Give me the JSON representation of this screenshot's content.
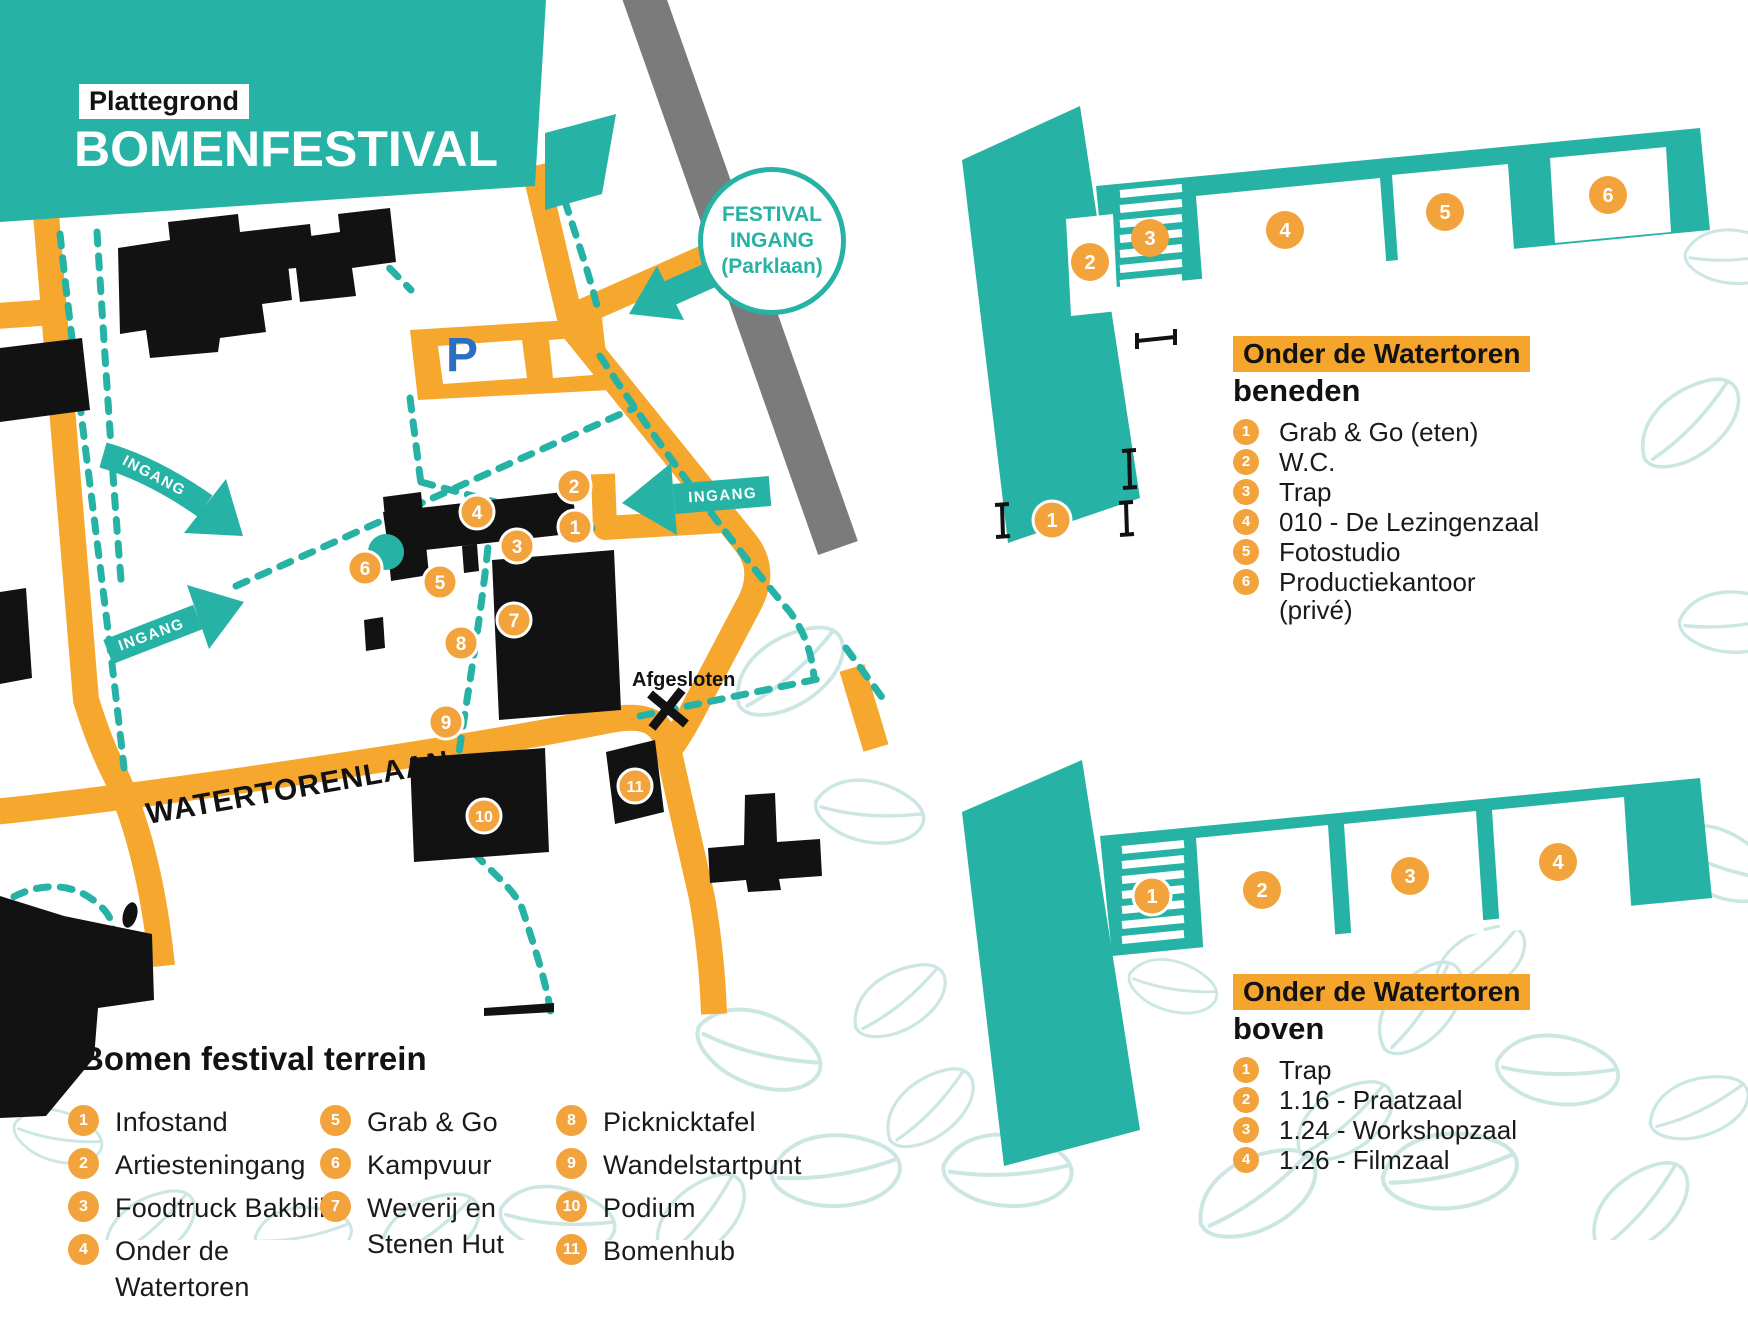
{
  "colors": {
    "teal": "#26B2A4",
    "orange": "#F6A72E",
    "marker": "#F2A33C",
    "highlight": "#F5A42C",
    "ink": "#121212",
    "gray_road": "#7B7B7B",
    "leaf": "#CBE6E3",
    "parking_blue": "#2B6FC4"
  },
  "title": {
    "badge": "Plattegrond",
    "main": "BOMENFESTIVAL"
  },
  "festival_entrance": {
    "line1": "FESTIVAL",
    "line2": "INGANG",
    "line3": "(Parklaan)"
  },
  "map": {
    "street_label": "WATERTORENLAAN",
    "closed_label": "Afgesloten",
    "entrance_label": "INGANG",
    "parking_label": "P",
    "markers": [
      {
        "number": "1"
      },
      {
        "number": "2"
      },
      {
        "number": "3"
      },
      {
        "number": "4"
      },
      {
        "number": "5"
      },
      {
        "number": "6"
      },
      {
        "number": "7"
      },
      {
        "number": "8"
      },
      {
        "number": "9"
      },
      {
        "number": "10"
      },
      {
        "number": "11"
      }
    ]
  },
  "terrain_legend": {
    "title": "Bomen festival terrein",
    "items": [
      {
        "number": "1",
        "label": "Infostand"
      },
      {
        "number": "2",
        "label": "Artiesteningang"
      },
      {
        "number": "3",
        "label": "Foodtruck Bakblik"
      },
      {
        "number": "4",
        "label": "Onder de\nWatertoren"
      },
      {
        "number": "5",
        "label": "Grab & Go"
      },
      {
        "number": "6",
        "label": "Kampvuur"
      },
      {
        "number": "7",
        "label": "Weverij en\nStenen Hut"
      },
      {
        "number": "8",
        "label": "Picknicktafel"
      },
      {
        "number": "9",
        "label": "Wandelstartpunt"
      },
      {
        "number": "10",
        "label": "Podium"
      },
      {
        "number": "11",
        "label": "Bomenhub"
      }
    ]
  },
  "floorplans": {
    "beneden": {
      "highlight": "Onder de Watertoren",
      "subtitle": "beneden",
      "items": [
        {
          "number": "1",
          "label": "Grab & Go (eten)"
        },
        {
          "number": "2",
          "label": "W.C."
        },
        {
          "number": "3",
          "label": "Trap"
        },
        {
          "number": "4",
          "label": "010 - De Lezingenzaal"
        },
        {
          "number": "5",
          "label": "Fotostudio"
        },
        {
          "number": "6",
          "label": "Productiekantoor\n(privé)"
        }
      ],
      "markers": [
        {
          "number": "1"
        },
        {
          "number": "2"
        },
        {
          "number": "3"
        },
        {
          "number": "4"
        },
        {
          "number": "5"
        },
        {
          "number": "6"
        }
      ]
    },
    "boven": {
      "highlight": "Onder de Watertoren",
      "subtitle": "boven",
      "items": [
        {
          "number": "1",
          "label": "Trap"
        },
        {
          "number": "2",
          "label": "1.16 - Praatzaal"
        },
        {
          "number": "3",
          "label": "1.24 - Workshopzaal"
        },
        {
          "number": "4",
          "label": "1.26 - Filmzaal"
        }
      ],
      "markers": [
        {
          "number": "1"
        },
        {
          "number": "2"
        },
        {
          "number": "3"
        },
        {
          "number": "4"
        }
      ]
    }
  }
}
